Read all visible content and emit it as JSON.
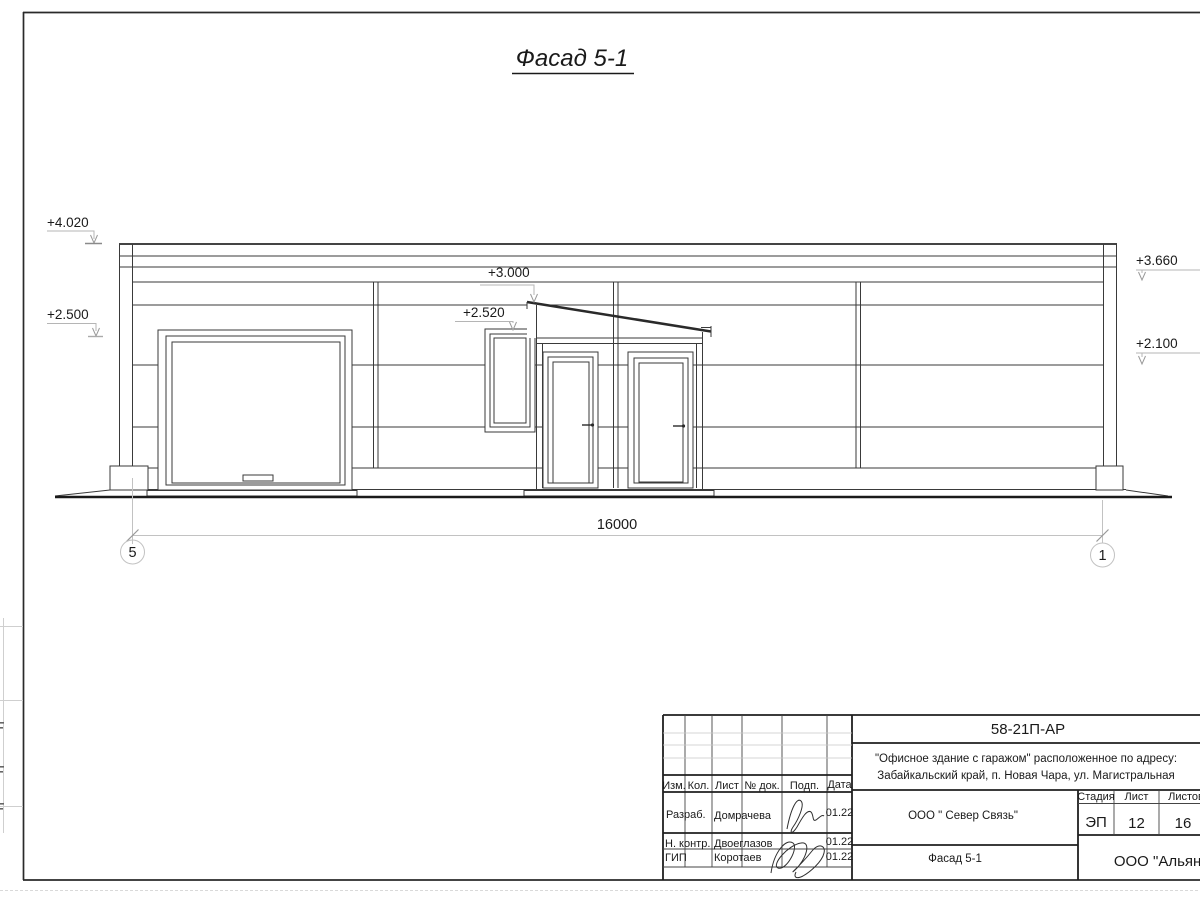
{
  "colors": {
    "paper": "#ffffff",
    "line": "#3a3a3a",
    "leader_gray": "#b5b5b5"
  },
  "title": "Фасад 5-1 ",
  "drawing": {
    "elevation_marks": [
      "+4.020",
      "+2.500",
      "+3.000",
      "+2.520",
      "+3.660",
      "+2.100"
    ],
    "dimension_total": "16000",
    "axes": [
      "5",
      "1"
    ]
  },
  "title_block": {
    "doc_number": "58-21П-АР",
    "project_address_line1": "\"Офисное здание с гаражом\" расположенное по адресу:",
    "project_address_line2": "Забайкальский край, п. Новая Чара, ул. Магистральная",
    "header": {
      "izm": "Изм.",
      "kol": "Кол.",
      "list": "Лист",
      "doc": "№ док.",
      "sign": "Подп.",
      "date": "Дата"
    },
    "roles": [
      {
        "role": "Разраб.",
        "name": "Домрачева",
        "date": "01.22"
      },
      {
        "role": "Н. контр.",
        "name": "Двоеглазов",
        "date": "01.22"
      },
      {
        "role": "ГИП",
        "name": "Коротаев",
        "date": "01.22"
      }
    ],
    "contractor": "ООО \" Север Связь\"",
    "sheet_name": "Фасад 5-1",
    "stage_label": "Стадия",
    "list_label": "Лист",
    "listov_label": "Листов",
    "stage": "ЭП",
    "sheet_number": "12",
    "sheet_count": "16",
    "organization": "ООО \"Альянс\""
  }
}
